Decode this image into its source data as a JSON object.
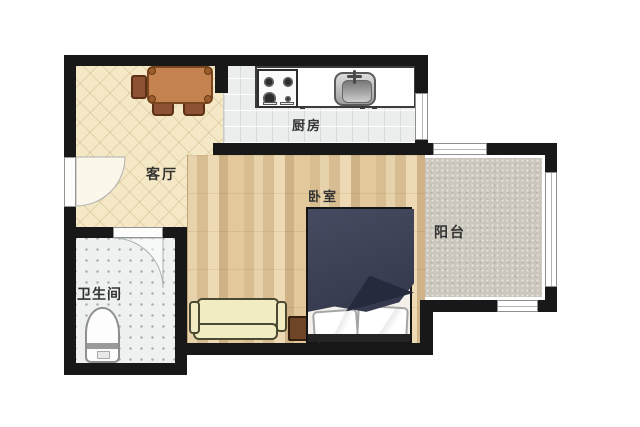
{
  "plan_title": "one-bedroom apartment floor plan",
  "rooms": {
    "living": {
      "label": "客厅"
    },
    "kitchen": {
      "label": "厨房"
    },
    "bedroom": {
      "label": "卧室"
    },
    "balcony": {
      "label": "阳台"
    },
    "bathroom": {
      "label": "卫生间"
    }
  },
  "furniture": {
    "dining_table": "dining-table",
    "dining_chairs": "dining-chairs",
    "stove": "gas-stove-4-burner",
    "sink": "kitchen-sink",
    "counter": "kitchen-counter",
    "sofa": "three-seat-sofa",
    "bed": "double-bed-with-duvet-and-pillows",
    "nightstand": "nightstand",
    "toilet": "toilet",
    "entrance_door": "entrance-door-swing",
    "bathroom_door": "bathroom-door-swing"
  },
  "colors": {
    "wall": "#181818",
    "living_floor": "#f4e8c6",
    "kitchen_floor": "#eceeee",
    "wood_floor": "#e2c99e",
    "balcony_floor": "#cbc7bd",
    "bathroom_floor": "#eef1f0",
    "duvet": "#3c4055",
    "duvet_fold": "#262a3d",
    "sofa": "#f1ecc1",
    "table": "#c3824f",
    "chair": "#8d5134",
    "nightstand": "#6e4526",
    "label": "#333333"
  }
}
